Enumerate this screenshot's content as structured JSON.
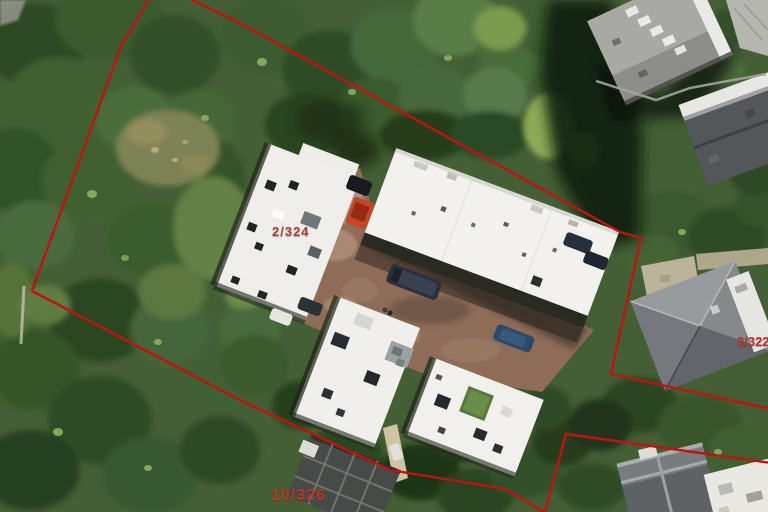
{
  "map": {
    "view": "aerial-photo-with-cadastral-overlay",
    "labels": [
      {
        "id": "parcel-2-324",
        "text": "2/324"
      },
      {
        "id": "parcel-10-326",
        "text": "10/326"
      },
      {
        "id": "parcel-3-322",
        "text": "3/322"
      }
    ],
    "colors": {
      "boundary_red": "#c41111",
      "label_red_muted": "#a8423a",
      "label_red_bright": "#bc352c",
      "tree_green_dark": "#2c4724",
      "roof_white": "#f1f0ec",
      "driveway_brick": "#8e6c58"
    },
    "boundaries": {
      "left_and_bottom": "M151,-4 L121,46 L32,291 L240,400 L390,470 L505,489 L549,515",
      "top_and_right": "M184,-4 L240,23 L620,232 L641,238 L611,374 L771,409",
      "lower_right_parcel": "M771,463 L566,434 L544,515"
    }
  }
}
